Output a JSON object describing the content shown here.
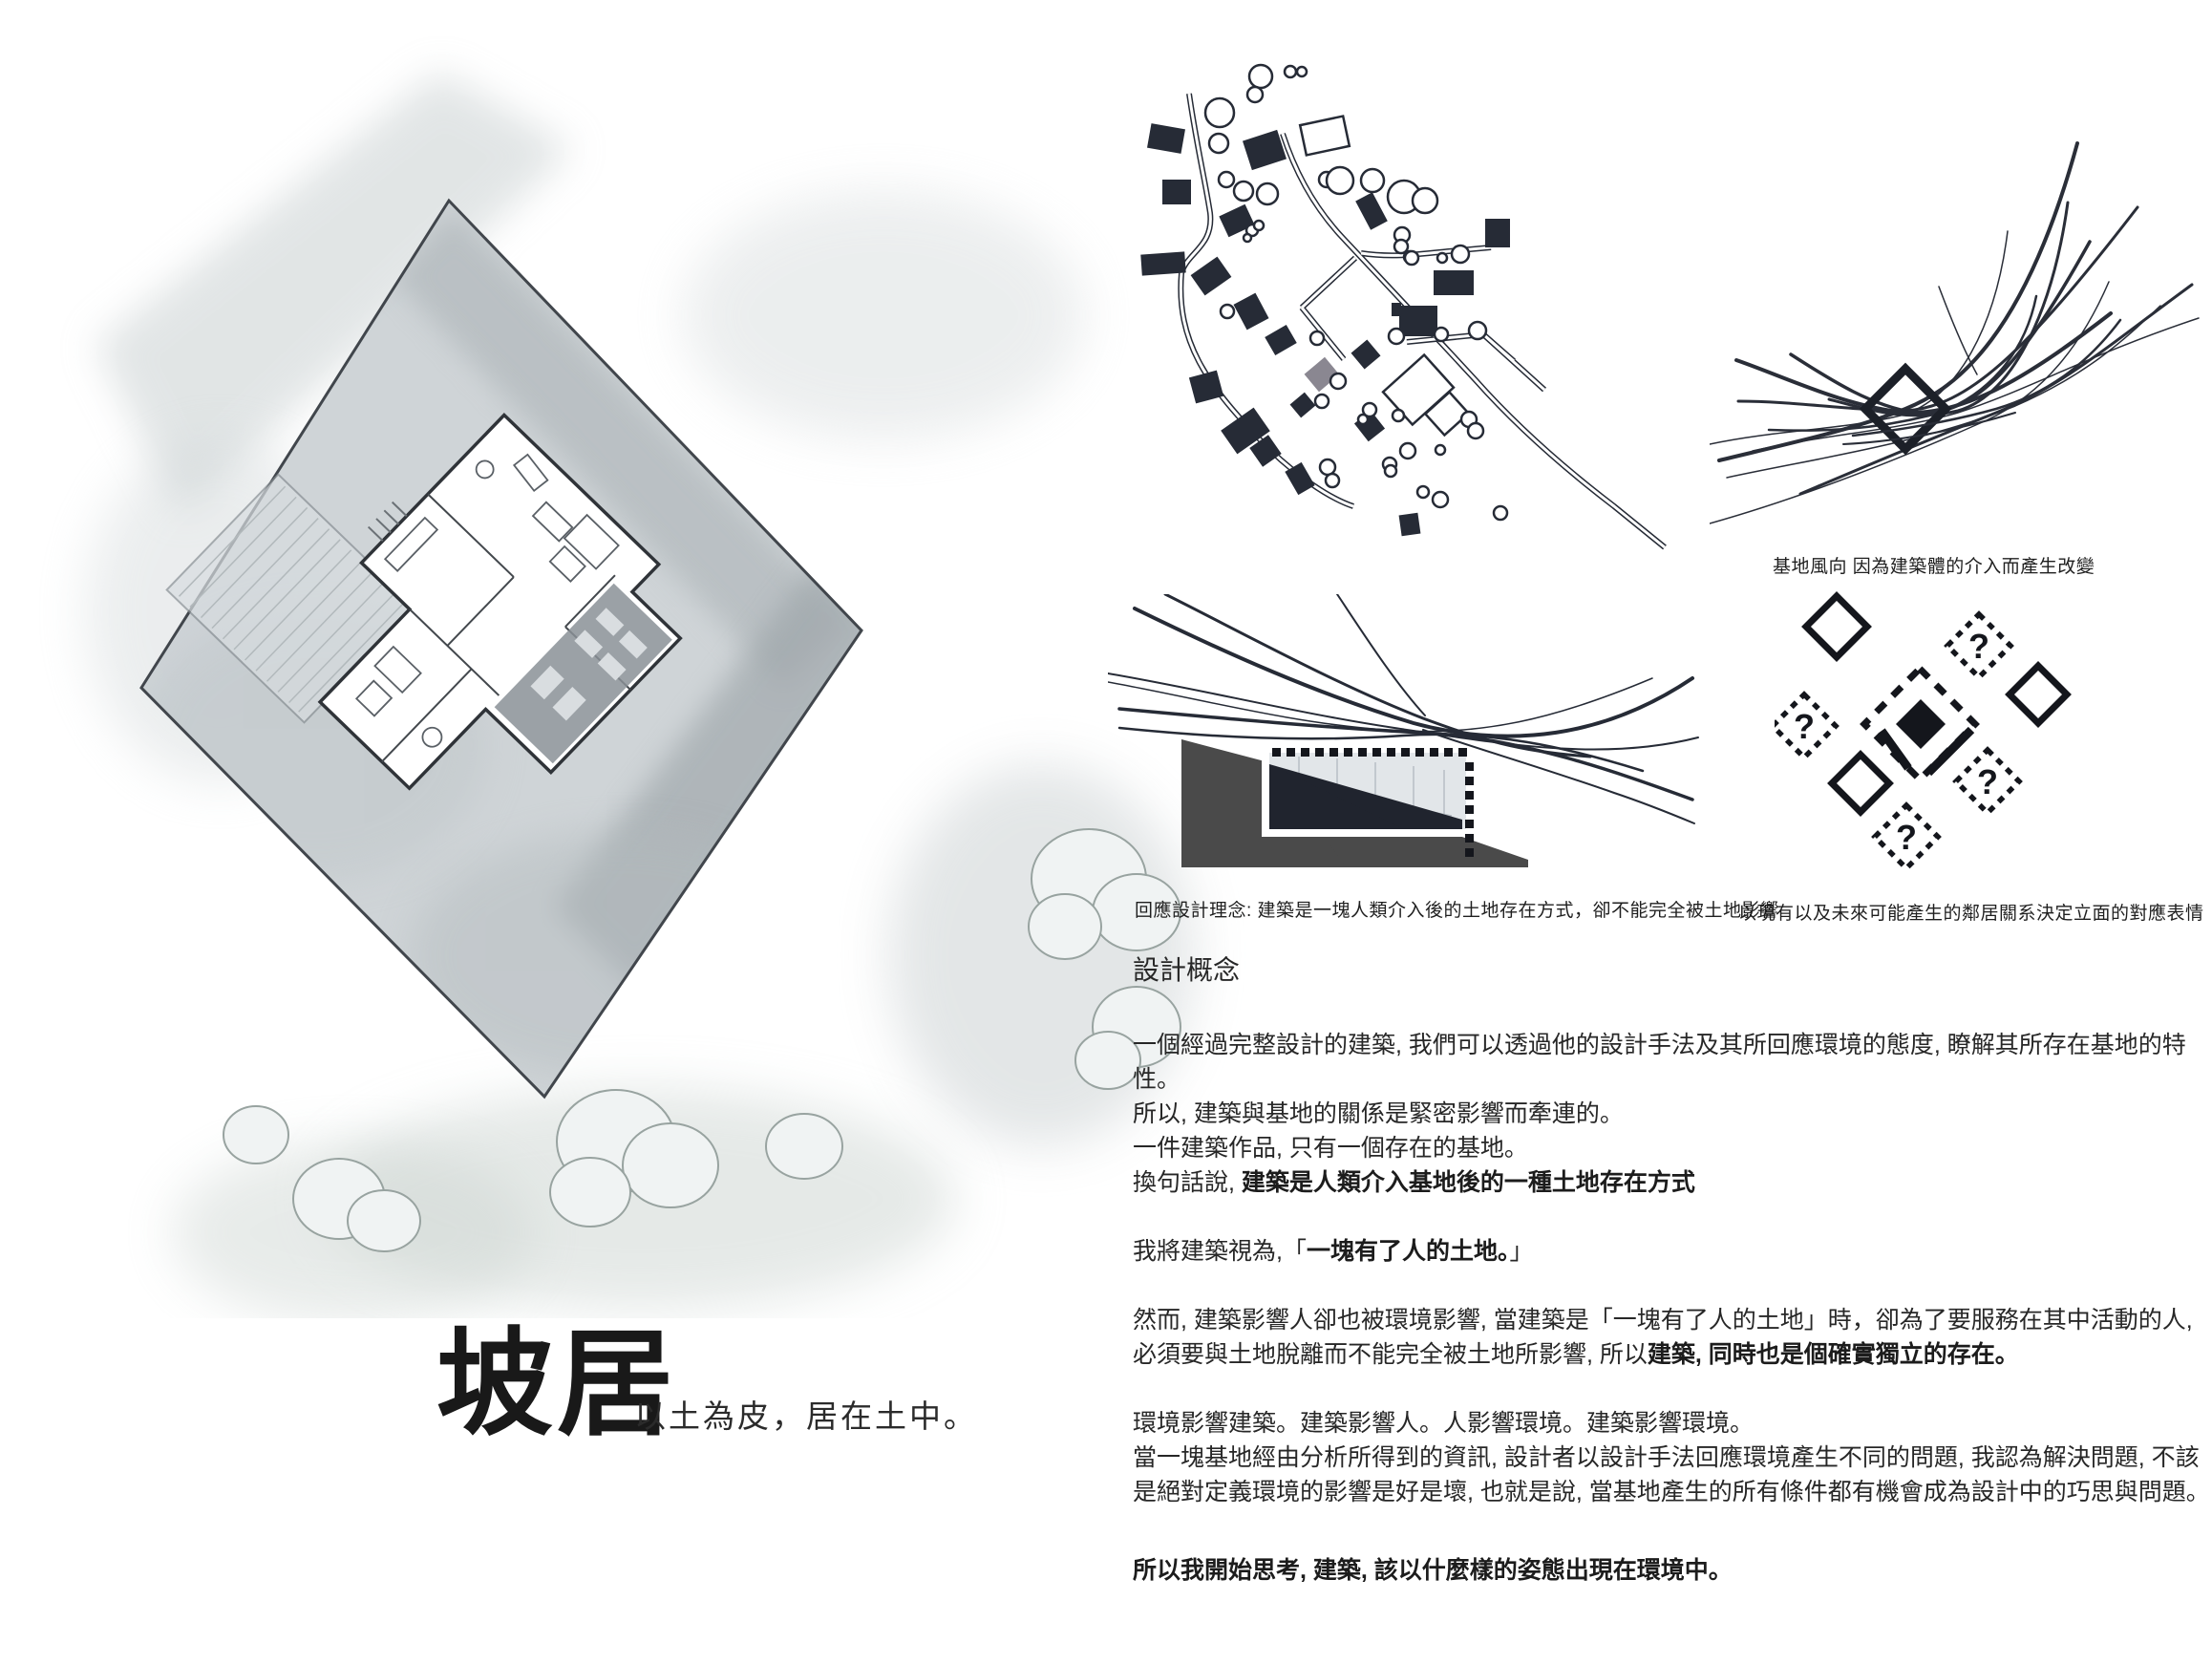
{
  "page": {
    "background": "#ffffff"
  },
  "title": {
    "main": "坡居",
    "tagline": "以土為皮，居在土中。"
  },
  "captions": {
    "wind": "基地風向 因為建築體的介入而產生改變",
    "section": "回應設計理念: 建築是一塊人類介入後的土地存在方式，卻不能完全被土地影響",
    "facade": "以現有以及未來可能產生的鄰居關系決定立面的對應表情"
  },
  "facade_diagram": {
    "question": "?"
  },
  "concept": {
    "heading": "設計概念",
    "p1": "一個經過完整設計的建築, 我們可以透過他的設計手法及其所回應環境的態度, 瞭解其所存在基地的特性。",
    "p2": "所以, 建築與基地的關係是緊密影響而牽連的。",
    "p3": "一件建築作品, 只有一個存在的基地。",
    "p4a": "換句話說, ",
    "p4b": "建築是人類介入基地後的一種土地存在方式",
    "p5a": "我將建築視為,「",
    "p5b": "一塊有了人的土地。",
    "p5c": "」",
    "p6a": "然而, 建築影響人卻也被環境影響, 當建築是「一塊有了人的土地」時，卻為了要服務在其中活動的人, 必須要與土地脫離而不能完全被土地所影響, 所以",
    "p6b": "建築, 同時也是個確實獨立的存在。",
    "p7": "環境影響建築。建築影響人。人影響環境。建築影響環境。",
    "p8": "當一塊基地經由分析所得到的資訊, 設計者以設計手法回應環境產生不同的問題, 我認為解決問題, 不該是絕對定義環境的影響是好是壞, 也就是說, 當基地產生的所有條件都有機會成為設計中的巧思與問題。",
    "p9": "所以我開始思考, 建築, 該以什麼樣的姿態出現在環境中。"
  },
  "colors": {
    "ink": "#262b36",
    "slope_gray": "#4a4a4a",
    "building_dark": "#20242e",
    "site_building_gray": "#8a8791",
    "pencil_light": "#ccd2d5"
  }
}
